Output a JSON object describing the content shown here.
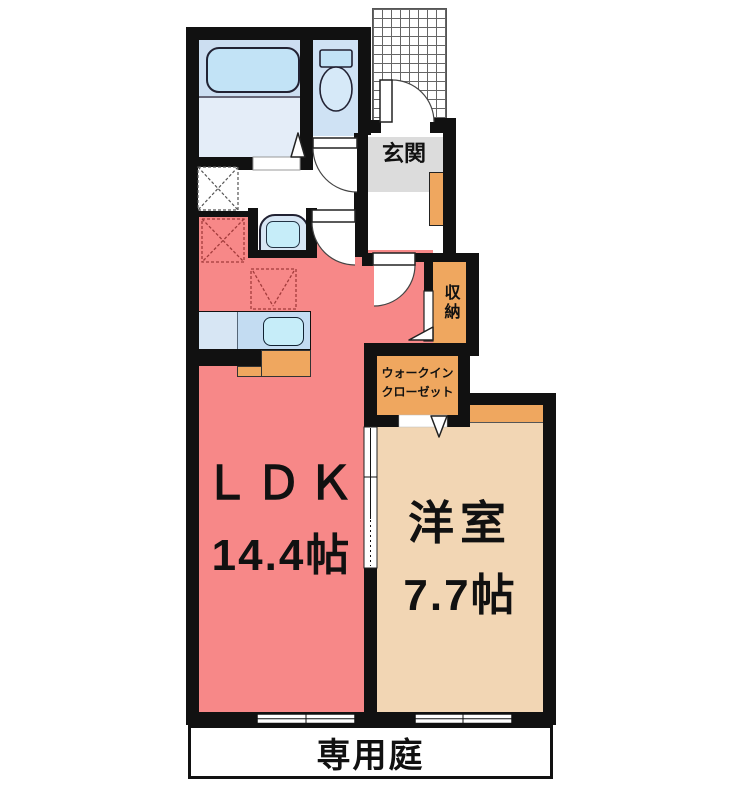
{
  "title": "1LDK apartment floor plan",
  "rooms": {
    "ldk": {
      "name": "ＬＤＫ",
      "size": "14.4帖"
    },
    "western_room": {
      "name": "洋室",
      "size": "7.7帖"
    },
    "entrance": {
      "label": "玄関"
    },
    "storage": {
      "label": "収納"
    },
    "walk_in_closet": {
      "line1": "ウォークイン",
      "line2": "クローゼット"
    },
    "private_garden": {
      "label": "専用庭"
    }
  },
  "fixtures": [
    "bathtub",
    "toilet",
    "vanity-sink",
    "kitchen-counter-sink",
    "washer-space",
    "fridge-space",
    "range-space",
    "shoe-cabinet",
    "entrance-porch-grid",
    "hinged-doors",
    "sliding-door",
    "sliding-windows",
    "closet-opening-arrows"
  ],
  "colors": {
    "wall": "#111111",
    "ldk": "#f78888",
    "western": "#f2d6b4",
    "closet_orange": "#efa75f",
    "bath_upper": "#ccdef1",
    "bath_lower": "#e4edf8",
    "toilet_room": "#cfe2f4",
    "fixture_blue": "#c2e3f6",
    "sink_blue": "#c6edf9",
    "counter_left": "#d7e6f4",
    "counter_right": "#c3dcf2",
    "tile_gray": "#dcdcdc",
    "dashed_red": "#a23b3b",
    "dashed_gray": "#555555"
  }
}
